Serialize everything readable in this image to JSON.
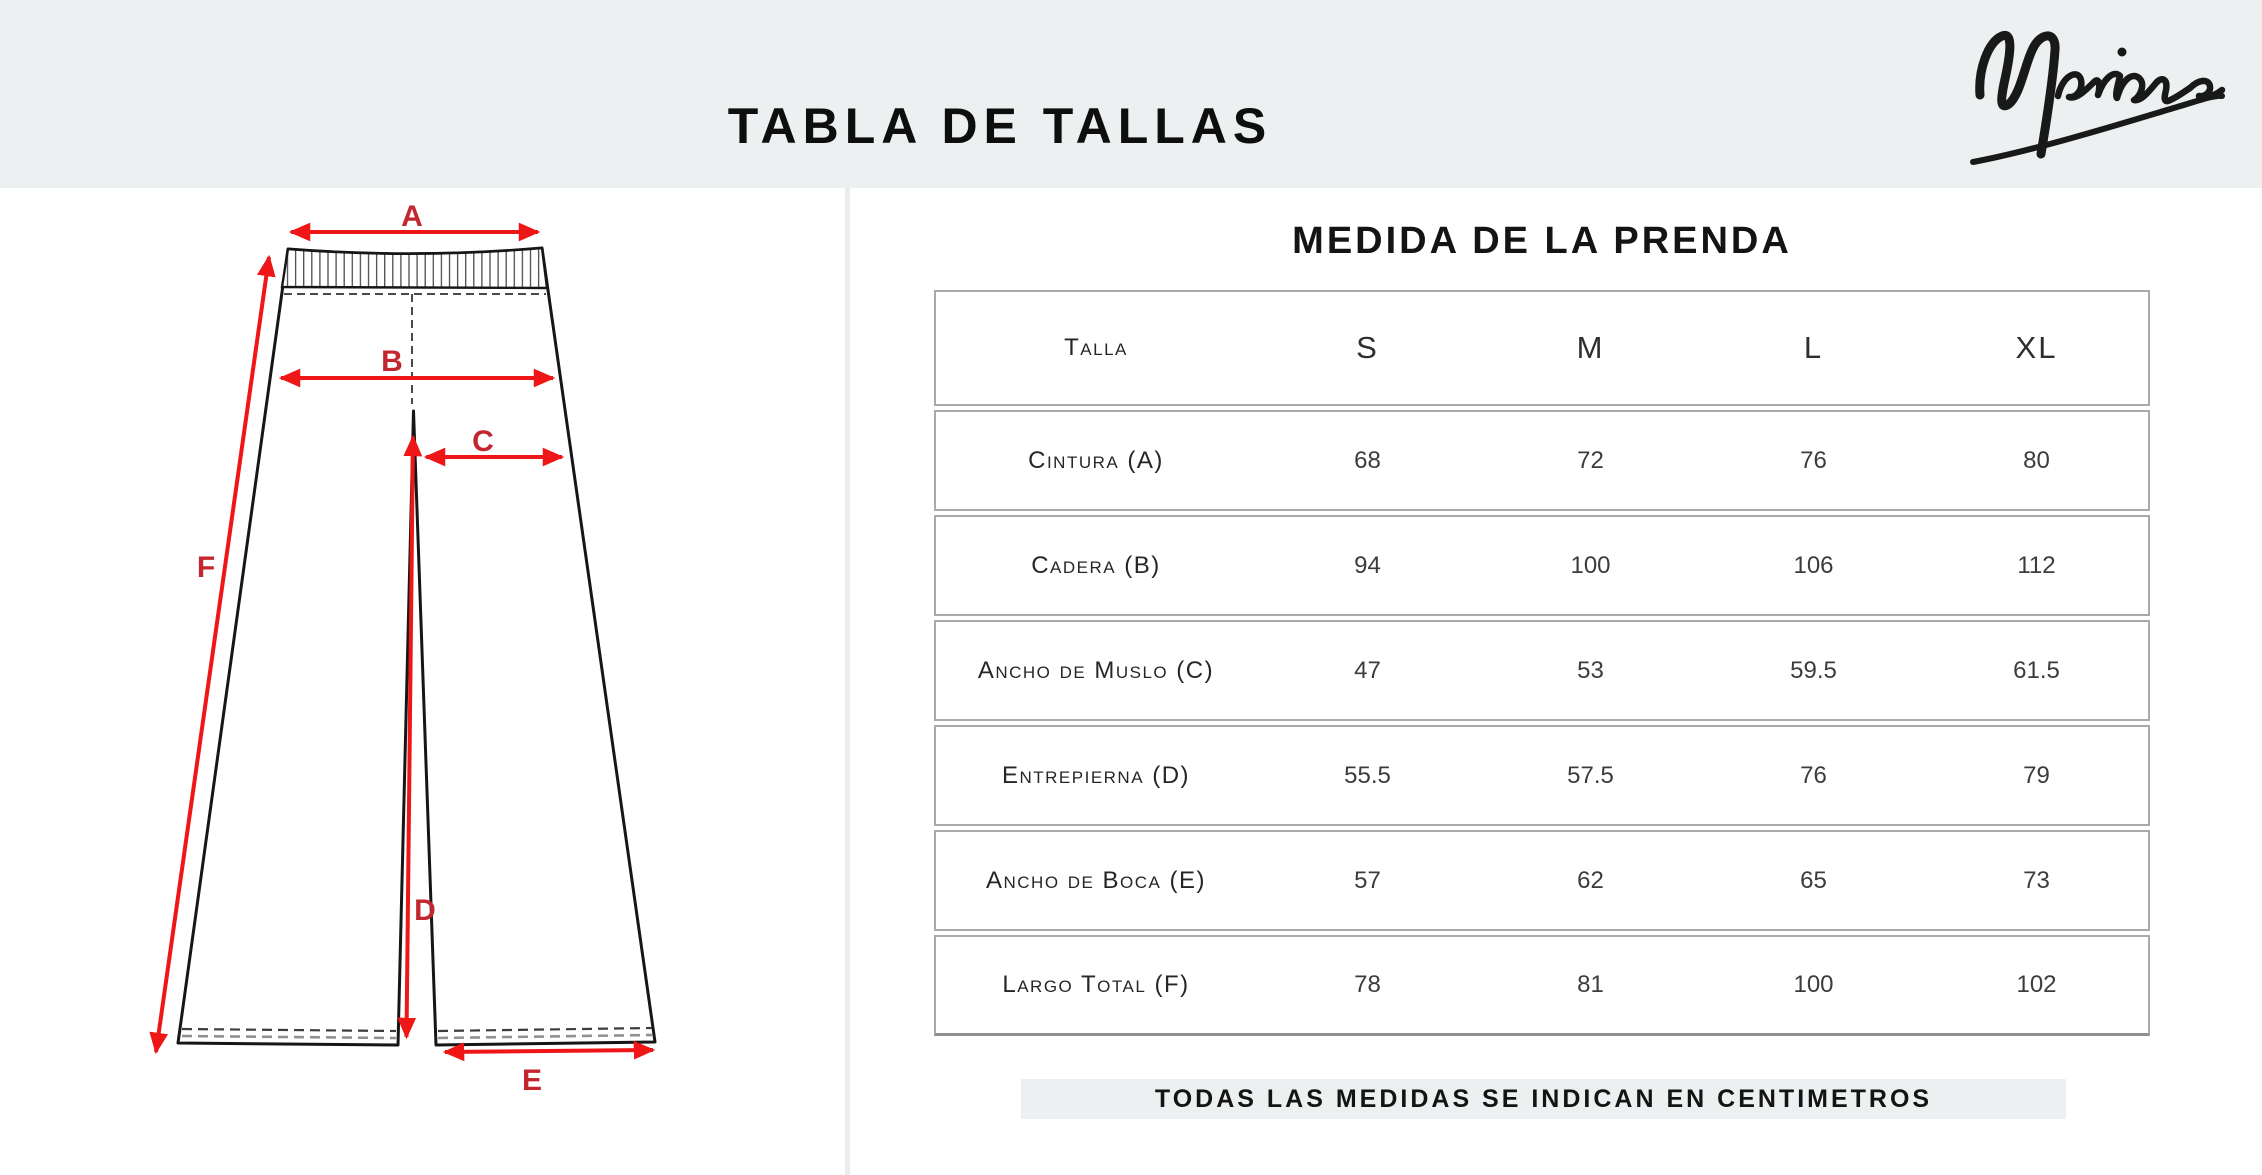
{
  "page": {
    "title": "TABLA DE TALLAS",
    "brand": "Marina"
  },
  "colors": {
    "band_gray": "#edf0f1",
    "arrow_red": "#ee1616",
    "label_red": "#c2262e",
    "table_border_gray": "#a9a9a9"
  },
  "diagram": {
    "labels": {
      "a": "A",
      "b": "B",
      "c": "C",
      "d": "D",
      "e": "E",
      "f": "F"
    }
  },
  "table": {
    "title": "MEDIDA DE LA PRENDA",
    "size_header": "Talla",
    "columns": [
      "S",
      "M",
      "L",
      "XL"
    ],
    "rows": [
      {
        "label": "Cintura (A)",
        "values": [
          "68",
          "72",
          "76",
          "80"
        ]
      },
      {
        "label": "Cadera (B)",
        "values": [
          "94",
          "100",
          "106",
          "112"
        ]
      },
      {
        "label": "Ancho de Muslo (C)",
        "values": [
          "47",
          "53",
          "59.5",
          "61.5"
        ]
      },
      {
        "label": "Entrepierna  (D)",
        "values": [
          "55.5",
          "57.5",
          "76",
          "79"
        ]
      },
      {
        "label": "Ancho de Boca (E)",
        "values": [
          "57",
          "62",
          "65",
          "73"
        ]
      },
      {
        "label": "Largo Total  (F)",
        "values": [
          "78",
          "81",
          "100",
          "102"
        ]
      }
    ],
    "note": "TODAS LAS MEDIDAS SE INDICAN EN CENTIMETROS"
  }
}
